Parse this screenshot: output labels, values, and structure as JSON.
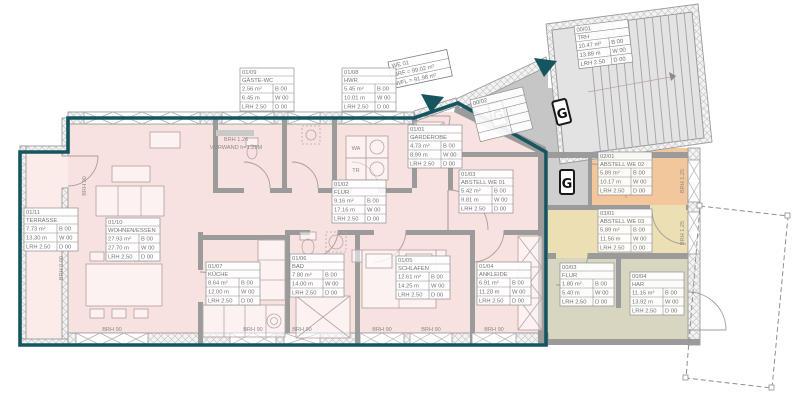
{
  "drawing_type": "apartment floor plan (Grundriss)",
  "colors": {
    "unit_boundary_teal": "#15555f",
    "room_fill_pink": "#f8e2e0",
    "common_hall_gray": "#c6c6c6",
    "stairwell_gray": "#e3e3e3",
    "abstell_we02_peach": "#f3c79c",
    "abstell_we03_tan": "#ecdfb4",
    "service_rooms_beige": "#d8d6c0",
    "wall_gray": "#9b9b9b"
  },
  "unit_tag": {
    "l1": "WE 01",
    "l2": "NRF = 99.02 m²",
    "l3": "WFL = 91.98 m²"
  },
  "symbols": {
    "gas": "G"
  },
  "annotations": {
    "brh90": "BRH 90",
    "brh125": "BRH 1.25",
    "brh000": "BRH 0.00",
    "vorwand_line1": "BRH 1.26",
    "vorwand_line2": "VORWAND h=1.25M",
    "wa": "WA",
    "tr": "TR"
  },
  "rooms": [
    {
      "code": "01/10",
      "name": "WOHNEN/ESSEN",
      "area": "27.93 m²",
      "perim": "27.70 m",
      "lrh": "LRH 2.50",
      "floor": "B 00",
      "wall": "W 00",
      "ceil": "D 00"
    },
    {
      "code": "01/07",
      "name": "KÜCHE",
      "area": "8.64 m²",
      "perim": "12.00 m",
      "lrh": "LRH 2.50",
      "floor": "B 00",
      "wall": "W 00",
      "ceil": "D 00"
    },
    {
      "code": "01/06",
      "name": "BAD",
      "area": "7.80 m²",
      "perim": "14.00 m",
      "lrh": "LRH 2.50",
      "floor": "B 00",
      "wall": "W 00",
      "ceil": "D 00"
    },
    {
      "code": "01/05",
      "name": "SCHLAFEN",
      "area": "12.61 m²",
      "perim": "14.25 m",
      "lrh": "LRH 2.50",
      "floor": "B 00",
      "wall": "W 00",
      "ceil": "D 00"
    },
    {
      "code": "01/04",
      "name": "ANKLEIDE",
      "area": "6.91 m²",
      "perim": "11.20 m",
      "lrh": "LRH 2.50",
      "floor": "B 00",
      "wall": "W 00",
      "ceil": "D 00"
    },
    {
      "code": "01/03",
      "name": "ABSTELL WE 01",
      "area": "5.42 m²",
      "perim": "9.81 m",
      "lrh": "LRH 2.50",
      "floor": "B 00",
      "wall": "W 00",
      "ceil": "D 00"
    },
    {
      "code": "01/02",
      "name": "FLUR",
      "area": "9.16 m²",
      "perim": "17.16 m",
      "lrh": "LRH 2.50",
      "floor": "B 00",
      "wall": "W 00",
      "ceil": "D 00"
    },
    {
      "code": "01/01",
      "name": "GARDEROBE",
      "area": "4.73 m²",
      "perim": "8.99 m",
      "lrh": "LRH 2.50",
      "floor": "B 00",
      "wall": "W 00",
      "ceil": "D 00"
    },
    {
      "code": "01/09",
      "name": "GÄSTE-WC",
      "area": "2.56 m²",
      "perim": "6.45 m",
      "lrh": "LRH 2.50",
      "floor": "B 00",
      "wall": "W 00",
      "ceil": "D 00"
    },
    {
      "code": "01/08",
      "name": "HWR",
      "area": "5.45 m²",
      "perim": "10.01 m",
      "lrh": "LRH 2.50",
      "floor": "B 00",
      "wall": "W 00",
      "ceil": "D 00"
    },
    {
      "code": "01/11",
      "name": "TERRASSE",
      "area": "7.73 m²",
      "perim": "13.30 m",
      "lrh": "LRH 2.50",
      "floor": "B 00",
      "wall": "W 00",
      "ceil": "D 00"
    },
    {
      "code": "00/01",
      "name": "TRH",
      "area": "10.47 m²",
      "perim": "13.89 m",
      "lrh": "LRH 2.50",
      "floor": "B 00",
      "wall": "W 00",
      "ceil": "D 00"
    },
    {
      "code": "02/01",
      "name": "ABSTELL WE 02",
      "area": "5.89 m²",
      "perim": "10.17 m",
      "lrh": "LRH 2.50",
      "floor": "B 00",
      "wall": "W 00",
      "ceil": "D 00"
    },
    {
      "code": "03/01",
      "name": "ABSTELL WE 03",
      "area": "5.89 m²",
      "perim": "11.56 m",
      "lrh": "LRH 2.50",
      "floor": "B 00",
      "wall": "W 00",
      "ceil": "D 00"
    },
    {
      "code": "00/03",
      "name": "FLUR",
      "area": "1.80 m²",
      "perim": "5.40 m",
      "lrh": "LRH 2.50",
      "floor": "B 00",
      "wall": "W 00",
      "ceil": "D 00"
    },
    {
      "code": "00/04",
      "name": "HAR",
      "area": "11.15 m²",
      "perim": "13.92 m",
      "lrh": "LRH 2.50",
      "floor": "B 00",
      "wall": "W 00",
      "ceil": "D 00"
    },
    {
      "code": "00/02",
      "name": "",
      "area": "",
      "perim": "",
      "lrh": "",
      "floor": "",
      "wall": "",
      "ceil": ""
    }
  ]
}
